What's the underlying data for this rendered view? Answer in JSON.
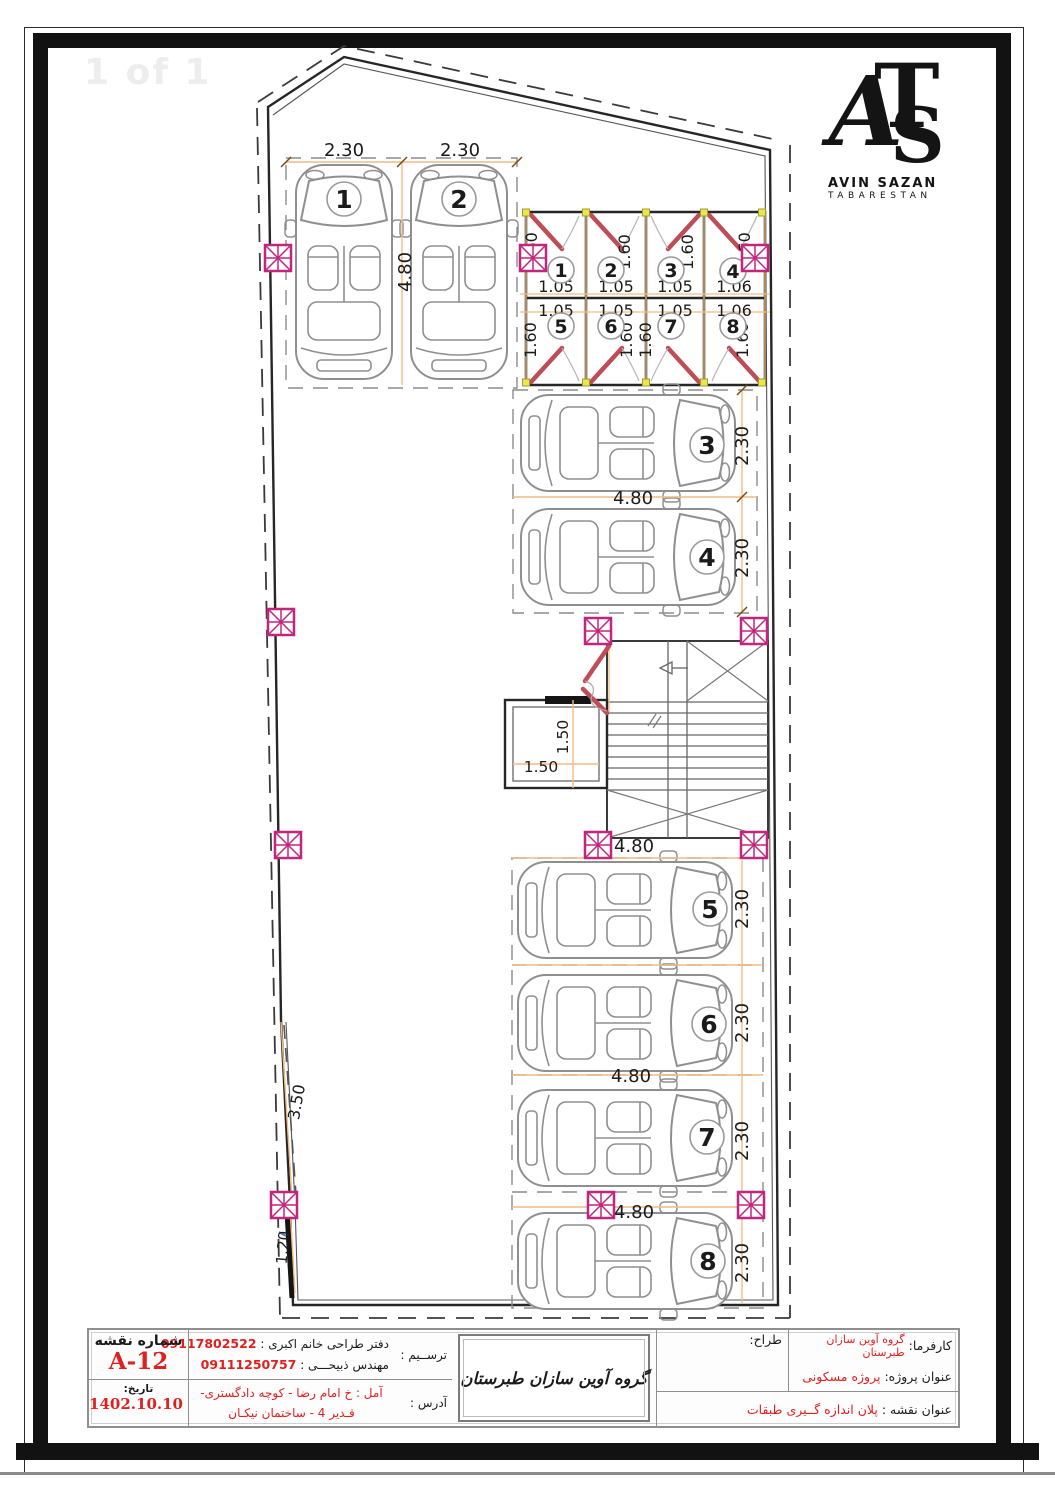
{
  "frame": {
    "watermark": "1 of 1"
  },
  "logo": {
    "monogram_a": "A",
    "monogram_t": "T",
    "monogram_s": "S",
    "line1": "AVIN SAZAN",
    "line2": "TABARESTAN"
  },
  "plan": {
    "dims": {
      "w230": "2.30",
      "l480": "4.80",
      "s160": "1.60",
      "s105": "1.05",
      "s106": "1.06",
      "e150": "1.50",
      "d350": "3.50",
      "d120": "1.20"
    },
    "car_numbers": [
      "1",
      "2",
      "3",
      "4",
      "5",
      "6",
      "7",
      "8"
    ],
    "storage_numbers": [
      "1",
      "2",
      "3",
      "4",
      "5",
      "6",
      "7",
      "8"
    ],
    "colors": {
      "dim_line": "#f2bc80",
      "marker": "#c2267c",
      "number_red": "#e01f1f",
      "door": "#bf4d58",
      "hinge": "#e9e74c",
      "wall": "#262626"
    }
  },
  "title_block": {
    "client_label": "کارفرما:",
    "client_value": "گروه آوین سازان طبرستان",
    "designer_label": "طراح:",
    "project_label": "عنوان پروژه:",
    "project_value": "پروژه مسکونی",
    "map_label": "عنوان نقشه :",
    "map_value": "پلان اندازه گــیری طبقات",
    "company_name": "گروه آوین سازان طبرستان",
    "draft_label": "ترســیم :",
    "draft_line1_text": "دفتر طراحی خانم اکبری :",
    "draft_line1_phone": "09117802522",
    "draft_line2_text": "مهندس ذبیحـــی :",
    "draft_line2_phone": "09111250757",
    "address_label": "آدرس :",
    "address_line1": "آمل : خ امام رضا - کوچه دادگستری-",
    "address_line2": "قـدیر 4 - ساختمان نیکـان",
    "sheet_no_label": "شماره نقشه",
    "sheet_no": "A-12",
    "date_label": "تاریخ:",
    "date_value": "1402.10.10"
  }
}
